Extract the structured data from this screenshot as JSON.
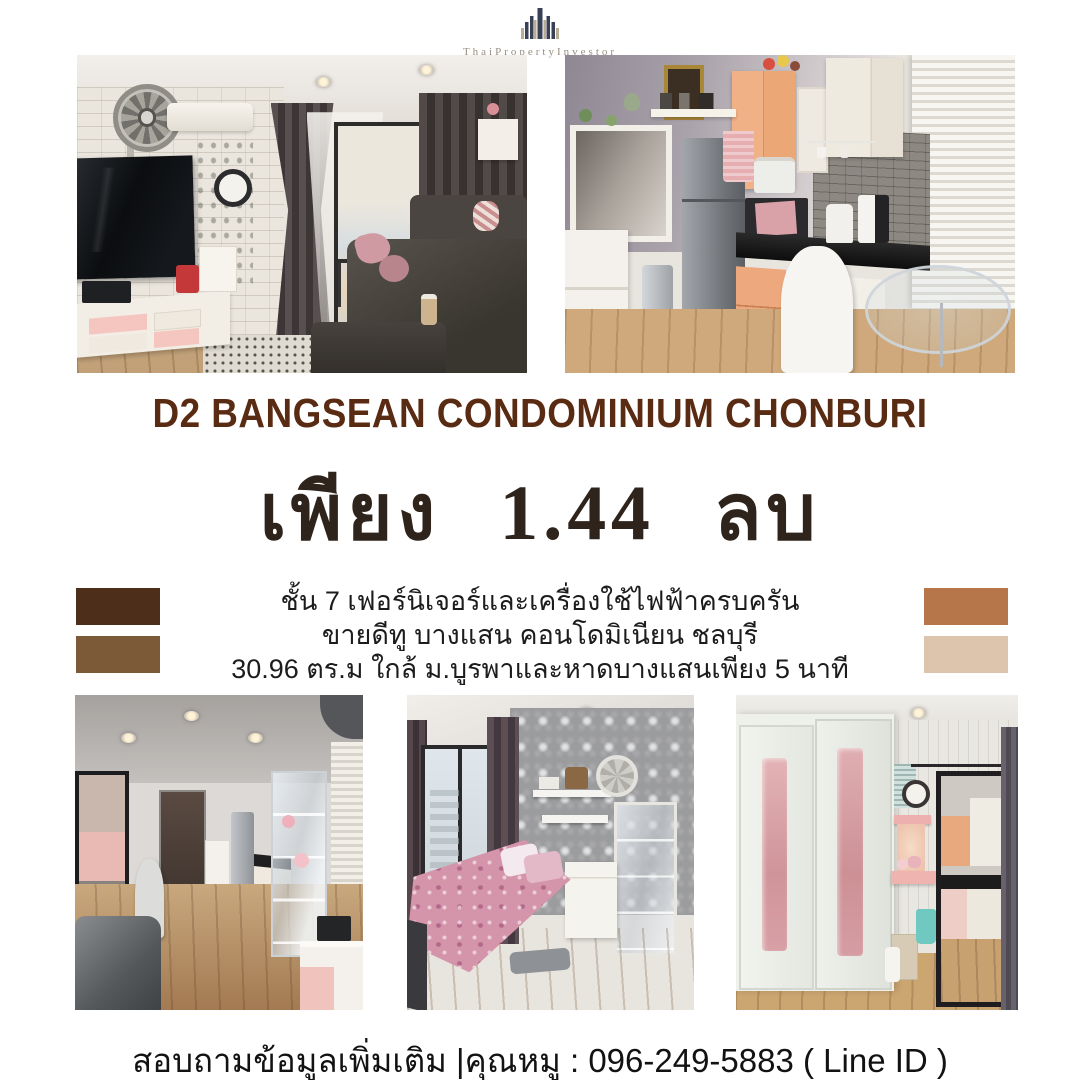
{
  "brand": {
    "name": "ThaiPropertyInvestor"
  },
  "headline": {
    "project": "D2 BANGSEAN CONDOMINIUM CHONBURI",
    "price": "เพียง 1.44 ลบ"
  },
  "details": {
    "lines": [
      "ชั้น 7 เฟอร์นิเจอร์และเครื่องใช้ไฟฟ้าครบครัน",
      "ขายดีทู บางแสน คอนโดมิเนียน ชลบุรี",
      "30.96 ตร.ม ใกล้ ม.บูรพาและหาดบางแสนเพียง 5 นาที"
    ]
  },
  "palette": {
    "title_brown": "#5a2b13",
    "price_brown": "#2f241c",
    "logo_navy": "#3a4055",
    "logo_tan": "#b9ad94",
    "swatches_left": [
      "#4d2e1a",
      "#7d5a37"
    ],
    "swatches_right": [
      "#b7764a",
      "#ddc4ac"
    ]
  },
  "photos": {
    "top": [
      {
        "name": "living-room"
      },
      {
        "name": "kitchen"
      }
    ],
    "bottom": [
      {
        "name": "hallway-view"
      },
      {
        "name": "bedroom"
      },
      {
        "name": "wardrobe-vanity"
      }
    ]
  },
  "footer": {
    "contact": "สอบถามข้อมูลเพิ่มเติม |คุณหมู : 096-249-5883 ( Line ID )"
  }
}
